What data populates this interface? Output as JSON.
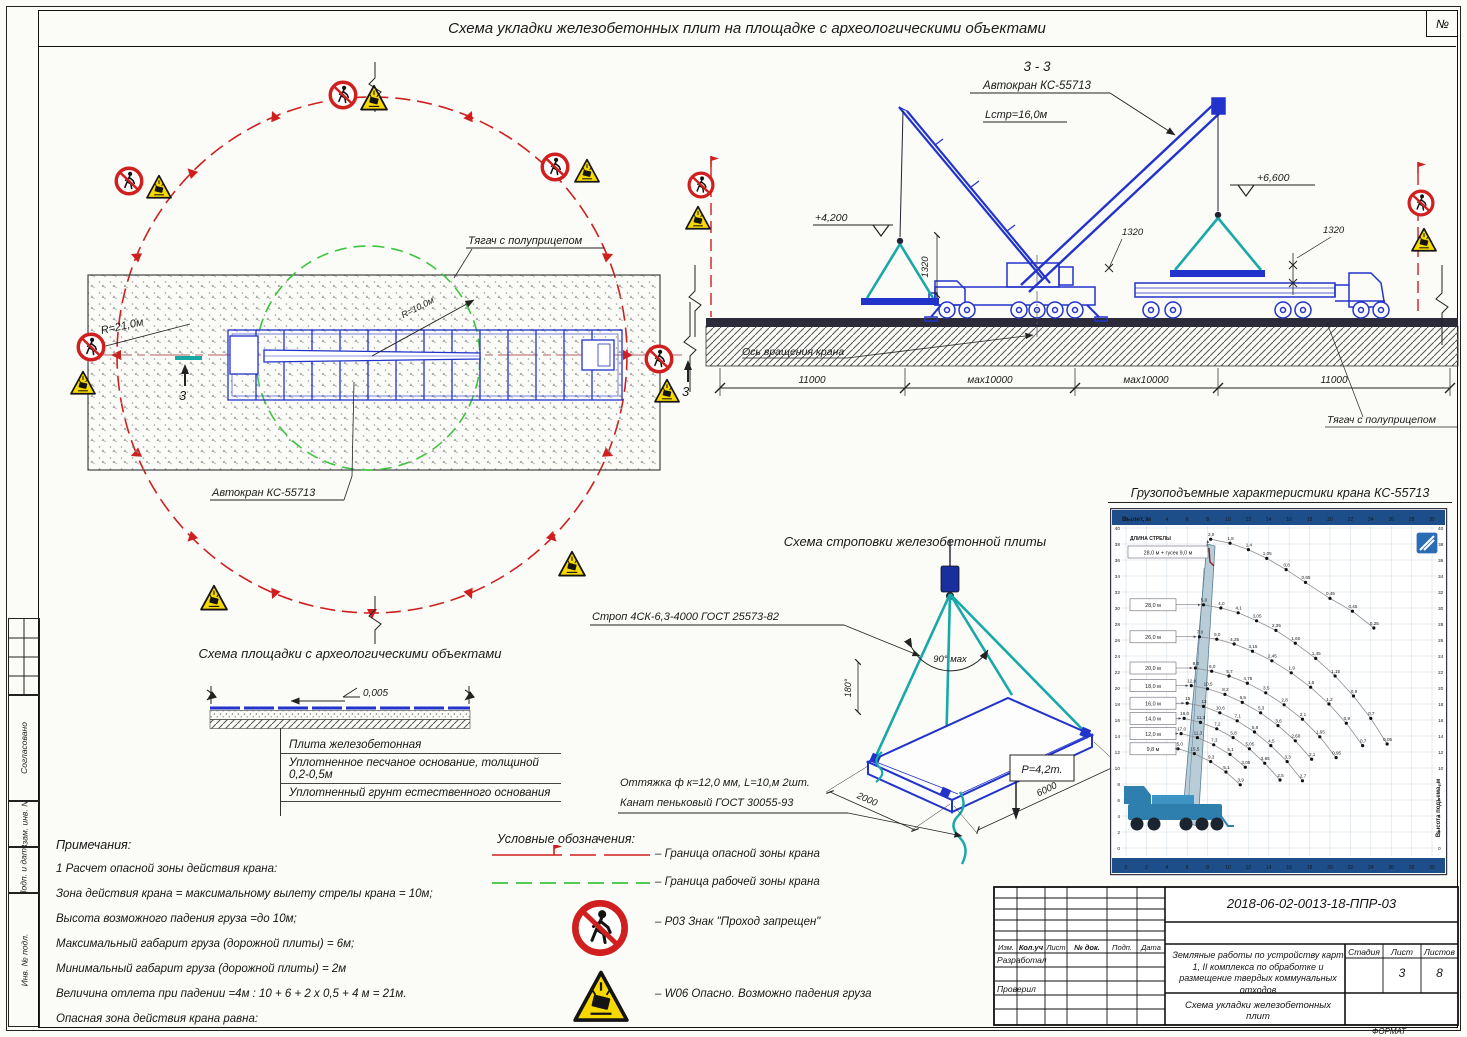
{
  "colors": {
    "crane_blue": "#2233cc",
    "sling_teal": "#18a8a8",
    "danger_red": "#cf1f1f",
    "work_green": "#3ec43e",
    "warn_yellow": "#f7d800",
    "chart_header": "#1d4e89"
  },
  "frame": {
    "num_label": "№",
    "format_label": "ФОРМАТ"
  },
  "title": "Схема укладки железобетонных плит на площадке с археологическими объектами",
  "sidebar": {
    "items": [
      "Согласовано",
      "Взам. инв. №",
      "Подп. и дата",
      "Инв. № подл."
    ]
  },
  "plan": {
    "truck_label": "Тягач с полуприцепом",
    "crane_label": "Автокран КС-55713",
    "radius_danger": "R=21,0м",
    "radius_work": "R=10,0м",
    "section_mark": "3"
  },
  "elevation": {
    "section_title": "3 - 3",
    "crane_label": "Автокран КС-55713",
    "boom_length": "Lстр=16,0м",
    "elev_left": "+4,200",
    "elev_right": "+6,600",
    "dim_small": "1320",
    "axis_label": "Ось вращения крана",
    "truck_label": "Тягач с полуприцепом",
    "dims": [
      "11000",
      "мах10000",
      "мах10000",
      "11000"
    ]
  },
  "platform": {
    "title": "Схема площадки с археологическими объектами",
    "slope": "0,005",
    "layers": [
      "Плита железобетонная",
      "Уплотненное песчаное основание, толщиной 0,2-0,5м",
      "Уплотненный грунт естественного основания"
    ]
  },
  "sling": {
    "title": "Схема строповки железобетонной плиты",
    "strop": "Строп 4СК-6,3-4000 ГОСТ 25573-82",
    "angle": "90° мах",
    "tilt": "180°",
    "dim_short": "2000",
    "dim_long": "6000",
    "guy": "Оттяжка ф к=12,0 мм, L=10,м   2шт.",
    "rope": "Канат пеньковый ГОСТ 30055-93",
    "weight": "P=4,2т."
  },
  "load_chart": {
    "title": "Грузоподъемные характеристики крана КС-55713",
    "header": "Вылет, м",
    "boom_caption": "ДЛИНА СТРЕЛЫ",
    "boom_note": "28,0 м + гусек 9,0 м",
    "right_label": "Высота подъема, м"
  },
  "notes": {
    "title": "Примечания:",
    "items": [
      "1    Расчет опасной зоны действия крана:",
      "Зона действия крана = максимальному вылету стрелы крана = 10м;",
      "Высота возможного падения груза =до 10м;",
      "Максимальный габарит груза (дорожной плиты) = 6м;",
      "Минимальный габарит груза (дорожной плиты)  = 2м",
      "Величина отлета при падении =4м : 10 + 6 + 2 х 0,5 + 4 м = 21м.",
      "Опасная зона действия крана равна:"
    ]
  },
  "legend": {
    "title": "Условные обозначения:",
    "items": [
      {
        "label": "– Граница опасной зоны крана"
      },
      {
        "label": "– Граница рабочей зоны крана"
      },
      {
        "label": "– Р03 Знак \"Проход запрещен\""
      },
      {
        "label": "– W06 Опасно. Возможно падения груза"
      }
    ]
  },
  "title_block": {
    "doc_number": "2018-06-02-0013-18-ППР-03",
    "columns": [
      "Изм.",
      "Кол.уч",
      "Лист",
      "№ док.",
      "Подп.",
      "Дата"
    ],
    "developed": "Разработал",
    "checked": "Проверил",
    "project": "Земляные работы по устройству карт 1, II комплекса по обработке и размещение твердых коммунальных отходов",
    "sheet_title": "Схема укладки железобетонных плит",
    "stage_label": "Стадия",
    "sheet_label": "Лист",
    "sheets_label": "Листов",
    "sheet_number": "3",
    "sheets_total": "8"
  },
  "chart_data": {
    "type": "line",
    "title": "Грузоподъемные характеристики крана КС-55713",
    "xlabel": "Вылет, м",
    "ylabel": "Высота подъема, м",
    "xlim": [
      0,
      30
    ],
    "ylim": [
      0,
      40
    ],
    "grid": true,
    "x_ticks": [
      "0",
      "2",
      "4",
      "6",
      "8",
      "10",
      "12",
      "14",
      "16",
      "18",
      "20",
      "22",
      "24",
      "26",
      "28",
      "30"
    ],
    "series": [
      {
        "name": "28,0 м + гусек 9,0 м",
        "boxed": false,
        "points": [
          [
            8.3,
            38.6,
            "2,0"
          ],
          [
            10.2,
            38.1,
            "1,8"
          ],
          [
            12,
            37.3,
            "1,4"
          ],
          [
            13.8,
            36.2,
            "1,05"
          ],
          [
            15.7,
            34.8,
            "0,8"
          ],
          [
            17.6,
            33.2,
            "0,65"
          ],
          [
            20,
            31.2,
            "0,45"
          ],
          [
            22.2,
            29.6,
            "0,45"
          ],
          [
            24.3,
            27.5,
            "0,25"
          ]
        ]
      },
      {
        "name": "28,0 м",
        "boxed": true,
        "points": [
          [
            7.6,
            30.4,
            "5,0"
          ],
          [
            9.3,
            30.0,
            "4,0"
          ],
          [
            11.0,
            29.4,
            "4,1"
          ],
          [
            12.8,
            28.4,
            "3,05"
          ],
          [
            14.7,
            27.2,
            "2,35"
          ],
          [
            16.6,
            25.6,
            "1,60"
          ],
          [
            18.6,
            23.7,
            "1,45"
          ],
          [
            20.5,
            21.5,
            "1,15"
          ],
          [
            22.3,
            19.0,
            "0,9"
          ],
          [
            24.0,
            16.2,
            "0,7"
          ],
          [
            25.6,
            13.0,
            "0,05"
          ]
        ]
      },
      {
        "name": "26,0 м",
        "boxed": true,
        "points": [
          [
            7.2,
            26.4,
            "7,0"
          ],
          [
            8.9,
            26.1,
            "5,0"
          ],
          [
            10.6,
            25.5,
            "4,25"
          ],
          [
            12.4,
            24.6,
            "3,15"
          ],
          [
            14.3,
            23.4,
            "2,45"
          ],
          [
            16.2,
            21.9,
            "1,9"
          ],
          [
            18.1,
            20.1,
            "1,5"
          ],
          [
            19.9,
            18.0,
            "1,2"
          ],
          [
            21.6,
            15.6,
            "0,9"
          ],
          [
            23.2,
            12.8,
            "0,7"
          ]
        ]
      },
      {
        "name": "20,0 м",
        "boxed": true,
        "points": [
          [
            6.8,
            22.5,
            "8,0"
          ],
          [
            8.4,
            22.1,
            "6,0"
          ],
          [
            10.1,
            21.5,
            "5,7"
          ],
          [
            11.9,
            20.6,
            "4,75"
          ],
          [
            13.7,
            19.4,
            "3,5"
          ],
          [
            15.5,
            17.9,
            "2,8"
          ],
          [
            17.3,
            16.1,
            "2,1"
          ],
          [
            19.0,
            13.9,
            "1,65"
          ],
          [
            20.6,
            11.3,
            "0,95"
          ]
        ]
      },
      {
        "name": "18,0 м",
        "boxed": true,
        "points": [
          [
            6.4,
            20.3,
            "12,0"
          ],
          [
            8.0,
            19.9,
            "10,5"
          ],
          [
            9.7,
            19.2,
            "8,2"
          ],
          [
            11.4,
            18.2,
            "6,5"
          ],
          [
            13.2,
            16.9,
            "5,3"
          ],
          [
            14.9,
            15.3,
            "3,6"
          ],
          [
            16.6,
            13.4,
            "2,60"
          ],
          [
            18.2,
            11.1,
            "2,1"
          ]
        ]
      },
      {
        "name": "16,0 м",
        "boxed": true,
        "points": [
          [
            6.0,
            18.1,
            "15"
          ],
          [
            7.6,
            17.7,
            "13"
          ],
          [
            9.2,
            16.9,
            "10,6"
          ],
          [
            10.9,
            15.9,
            "7,1"
          ],
          [
            12.6,
            14.5,
            "5,8"
          ],
          [
            14.2,
            12.8,
            "4,5"
          ],
          [
            15.8,
            10.8,
            "3,3"
          ],
          [
            17.3,
            8.4,
            "2,7"
          ]
        ]
      },
      {
        "name": "14,0 м",
        "boxed": true,
        "points": [
          [
            5.7,
            16.2,
            "16,0"
          ],
          [
            7.3,
            15.7,
            "11,3"
          ],
          [
            8.9,
            14.9,
            "7,2"
          ],
          [
            10.5,
            13.8,
            "5,8"
          ],
          [
            12.1,
            12.4,
            "5,05"
          ],
          [
            13.6,
            10.6,
            "3,65"
          ],
          [
            15.1,
            8.5,
            "2,5"
          ]
        ]
      },
      {
        "name": "12,0 м",
        "boxed": true,
        "points": [
          [
            5.4,
            14.3,
            "17,0"
          ],
          [
            7.0,
            13.8,
            "11,3"
          ],
          [
            8.6,
            12.9,
            "7,3"
          ],
          [
            10.2,
            11.7,
            "5,1"
          ],
          [
            11.7,
            10.1,
            "3,05"
          ]
        ]
      },
      {
        "name": "9,8 м",
        "boxed": true,
        "points": [
          [
            5.1,
            12.4,
            "25,0"
          ],
          [
            6.7,
            11.8,
            "15,5"
          ],
          [
            8.3,
            10.8,
            "9,3"
          ],
          [
            9.8,
            9.5,
            "5,1"
          ],
          [
            11.2,
            7.9,
            "3,9"
          ]
        ]
      }
    ]
  }
}
